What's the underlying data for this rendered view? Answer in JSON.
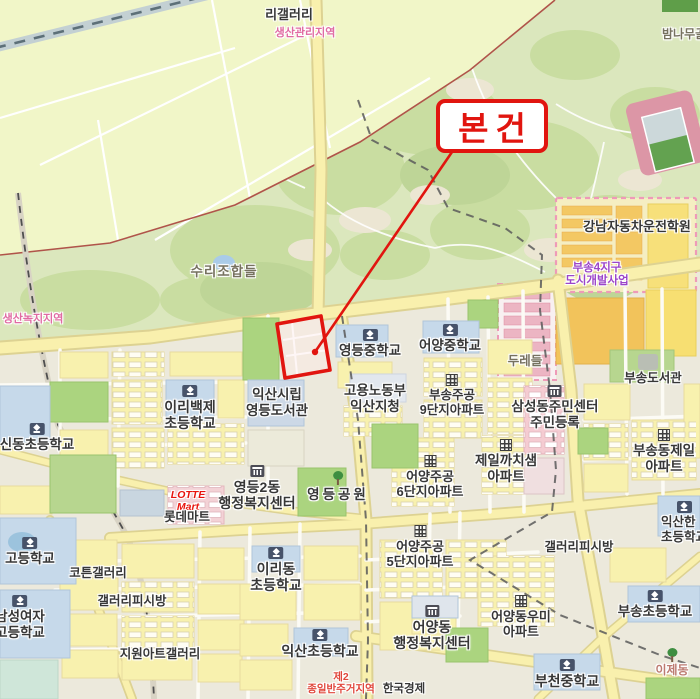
{
  "annotation": {
    "subject_label": "본건",
    "color": "#e1150f",
    "box": {
      "x": 436,
      "y": 99,
      "w": 112,
      "h": 54
    },
    "line": {
      "x1": 452,
      "y1": 152,
      "x2": 315,
      "y2": 352
    },
    "dot": {
      "x": 315,
      "y": 352,
      "r": 3.2
    },
    "parcel_points": "277,324 321,316 330,370 285,378"
  },
  "map": {
    "labels": [
      {
        "name": "ri-gallery",
        "lines": [
          "리갤러리"
        ],
        "x": 289,
        "y": 7,
        "size": 13
      },
      {
        "name": "zone-production-management",
        "lines": [
          "생산관리지역"
        ],
        "x": 305,
        "y": 27,
        "size": 11,
        "color": "pink"
      },
      {
        "name": "bamnamugol",
        "lines": [
          "밤나무골"
        ],
        "x": 662,
        "y": 28,
        "size": 12,
        "color": "gray",
        "align": "left"
      },
      {
        "name": "surijohapdeul",
        "lines": [
          "수리조합들"
        ],
        "x": 224,
        "y": 264,
        "size": 13.5,
        "color": "gray",
        "ls": 1
      },
      {
        "name": "zone-production-green",
        "lines": [
          "생산녹지지역"
        ],
        "x": 33,
        "y": 313,
        "size": 11,
        "color": "pink"
      },
      {
        "name": "gangnam-driving-school",
        "lines": [
          "강남자동차운전학원"
        ],
        "x": 637,
        "y": 219,
        "size": 13
      },
      {
        "name": "busong4-district-development",
        "lines": [
          "부송4지구",
          "도시개발사업"
        ],
        "x": 597,
        "y": 262,
        "size": 11.5,
        "color": "purple"
      },
      {
        "name": "duredeul",
        "lines": [
          "두레들"
        ],
        "x": 525,
        "y": 354,
        "size": 12.5,
        "color": "gray"
      },
      {
        "name": "busong-library",
        "lines": [
          "부송도서관"
        ],
        "x": 653,
        "y": 371,
        "size": 12.5
      },
      {
        "name": "yeongdeung-middle-school",
        "lines": [
          "영등중학교"
        ],
        "x": 370,
        "y": 329,
        "size": 13.5,
        "icon": "school"
      },
      {
        "name": "eoyang-middle-school",
        "lines": [
          "어양중학교"
        ],
        "x": 450,
        "y": 324,
        "size": 13.5,
        "icon": "school"
      },
      {
        "name": "employment-labor-iksan-office",
        "lines": [
          "고용노동부",
          "익산지청"
        ],
        "x": 375,
        "y": 383,
        "size": 13.5
      },
      {
        "name": "busong-jugong-9danji-apt",
        "lines": [
          "부송주공",
          "9단지아파트"
        ],
        "x": 452,
        "y": 374,
        "size": 12.5,
        "icon": "apartment"
      },
      {
        "name": "iksan-yeongdeung-library",
        "lines": [
          "익산시립",
          "영등도서관"
        ],
        "x": 277,
        "y": 387,
        "size": 13.5
      },
      {
        "name": "samseongdong-community-center",
        "lines": [
          "삼성동주민센터",
          "주민등록"
        ],
        "x": 555,
        "y": 385,
        "size": 13.5,
        "icon": "gov"
      },
      {
        "name": "jeil-kkachisaem-apt",
        "lines": [
          "제일까치샘",
          "아파트"
        ],
        "x": 506,
        "y": 439,
        "size": 13.5,
        "icon": "apartment"
      },
      {
        "name": "busongdong-jeil-apt",
        "lines": [
          "부송동제일",
          "아파트"
        ],
        "x": 664,
        "y": 429,
        "size": 13.5,
        "icon": "apartment"
      },
      {
        "name": "sindong-elementary-school",
        "lines": [
          "신동초등학교"
        ],
        "x": 37,
        "y": 423,
        "size": 13.5,
        "icon": "school"
      },
      {
        "name": "iribaekje-elementary-school",
        "lines": [
          "이리백제",
          "초등학교"
        ],
        "x": 190,
        "y": 385,
        "size": 14,
        "icon": "school"
      },
      {
        "name": "yeongdeung2dong-admin-center",
        "lines": [
          "영등2동",
          "행정복지센터"
        ],
        "x": 257,
        "y": 465,
        "size": 14,
        "icon": "gov"
      },
      {
        "name": "yeongdeung-park",
        "lines": [
          "영등공원"
        ],
        "x": 338,
        "y": 471,
        "size": 13.5,
        "icon": "tree",
        "ls": 3
      },
      {
        "name": "eoyang-jugong-6danji-apt",
        "lines": [
          "어양주공",
          "6단지아파트"
        ],
        "x": 430,
        "y": 455,
        "size": 13,
        "icon": "apartment"
      },
      {
        "name": "eoyang-jugong-5danji-apt",
        "lines": [
          "어양주공",
          "5단지아파트"
        ],
        "x": 420,
        "y": 525,
        "size": 13,
        "icon": "apartment"
      },
      {
        "name": "lotte-mart-en",
        "lines": [
          "LOTTE",
          "Mart"
        ],
        "x": 188,
        "y": 489,
        "size": 10.5,
        "color": "lotte"
      },
      {
        "name": "lotte-mart-ko",
        "lines": [
          "롯데마트"
        ],
        "x": 187,
        "y": 510,
        "size": 12.5
      },
      {
        "name": "cotton-gallery",
        "lines": [
          "코튼갤러리"
        ],
        "x": 98,
        "y": 566,
        "size": 12.5
      },
      {
        "name": "gallery-pc-room-west",
        "lines": [
          "갤러리피시방"
        ],
        "x": 132,
        "y": 594,
        "size": 12.5
      },
      {
        "name": "jiwon-art-gallery",
        "lines": [
          "지원아트갤러리"
        ],
        "x": 160,
        "y": 647,
        "size": 12.5
      },
      {
        "name": "high-school-west",
        "lines": [
          "고등학교"
        ],
        "x": 30,
        "y": 537,
        "size": 13.5,
        "icon": "school"
      },
      {
        "name": "namseong-girls-high-school",
        "lines": [
          "남성여자",
          "고등학교"
        ],
        "x": 20,
        "y": 595,
        "size": 13.5,
        "icon": "school"
      },
      {
        "name": "iridong-elementary-school",
        "lines": [
          "이리동",
          "초등학교"
        ],
        "x": 276,
        "y": 547,
        "size": 14,
        "icon": "school"
      },
      {
        "name": "iksan-elementary-school",
        "lines": [
          "익산초등학교"
        ],
        "x": 320,
        "y": 629,
        "size": 14,
        "icon": "school"
      },
      {
        "name": "eoyangdong-admin-center",
        "lines": [
          "어양동",
          "행정복지센터"
        ],
        "x": 432,
        "y": 605,
        "size": 14,
        "icon": "gov"
      },
      {
        "name": "eoyangdong-woomi-apt",
        "lines": [
          "어양동우미",
          "아파트"
        ],
        "x": 521,
        "y": 595,
        "size": 13,
        "icon": "apartment"
      },
      {
        "name": "busong-elementary-school",
        "lines": [
          "부송초등학교"
        ],
        "x": 655,
        "y": 590,
        "size": 13.5,
        "icon": "school"
      },
      {
        "name": "bucheon-middle-school",
        "lines": [
          "부천중학교"
        ],
        "x": 567,
        "y": 659,
        "size": 14,
        "icon": "school"
      },
      {
        "name": "gallery-pc-room-east",
        "lines": [
          "갤러리피시방"
        ],
        "x": 579,
        "y": 540,
        "size": 12.5
      },
      {
        "name": "iksanhan-elementary-school",
        "lines": [
          "익산한",
          "초등학교"
        ],
        "x": 661,
        "y": 501,
        "size": 12.5,
        "icon": "school",
        "align": "left"
      },
      {
        "name": "ijedong",
        "lines": [
          "이제동"
        ],
        "x": 672,
        "y": 648,
        "size": 12,
        "color": "brownred",
        "icon": "tree"
      },
      {
        "name": "zone-residential-type2",
        "lines": [
          "제2",
          "종일반주거지역"
        ],
        "x": 341,
        "y": 671,
        "size": 10.5,
        "color": "redzone"
      },
      {
        "name": "hankook-gyeongje",
        "lines": [
          "한국경제"
        ],
        "x": 404,
        "y": 683,
        "size": 11.5
      }
    ]
  }
}
